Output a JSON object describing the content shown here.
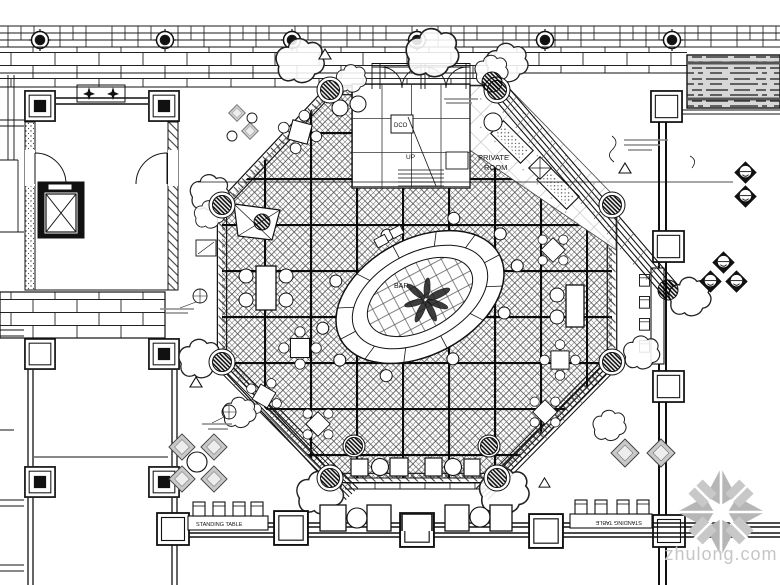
{
  "title": "Restaurant lobby floor plan (CAD drawing)",
  "labels": {
    "private_room_1": "PRIVATE",
    "private_room_2": "ROOM",
    "dco": "DCO",
    "up": "UP",
    "bar": "BAR",
    "standing_table_left": "STANDING TABLE",
    "standing_table_right": "STANDING TABLE"
  },
  "watermark": {
    "text": "zhulong.com",
    "color": "#c6c6c6"
  },
  "colors": {
    "line": "#1a1a1a",
    "hatch": "#555555",
    "seat_gray": "#c9c9c9"
  }
}
